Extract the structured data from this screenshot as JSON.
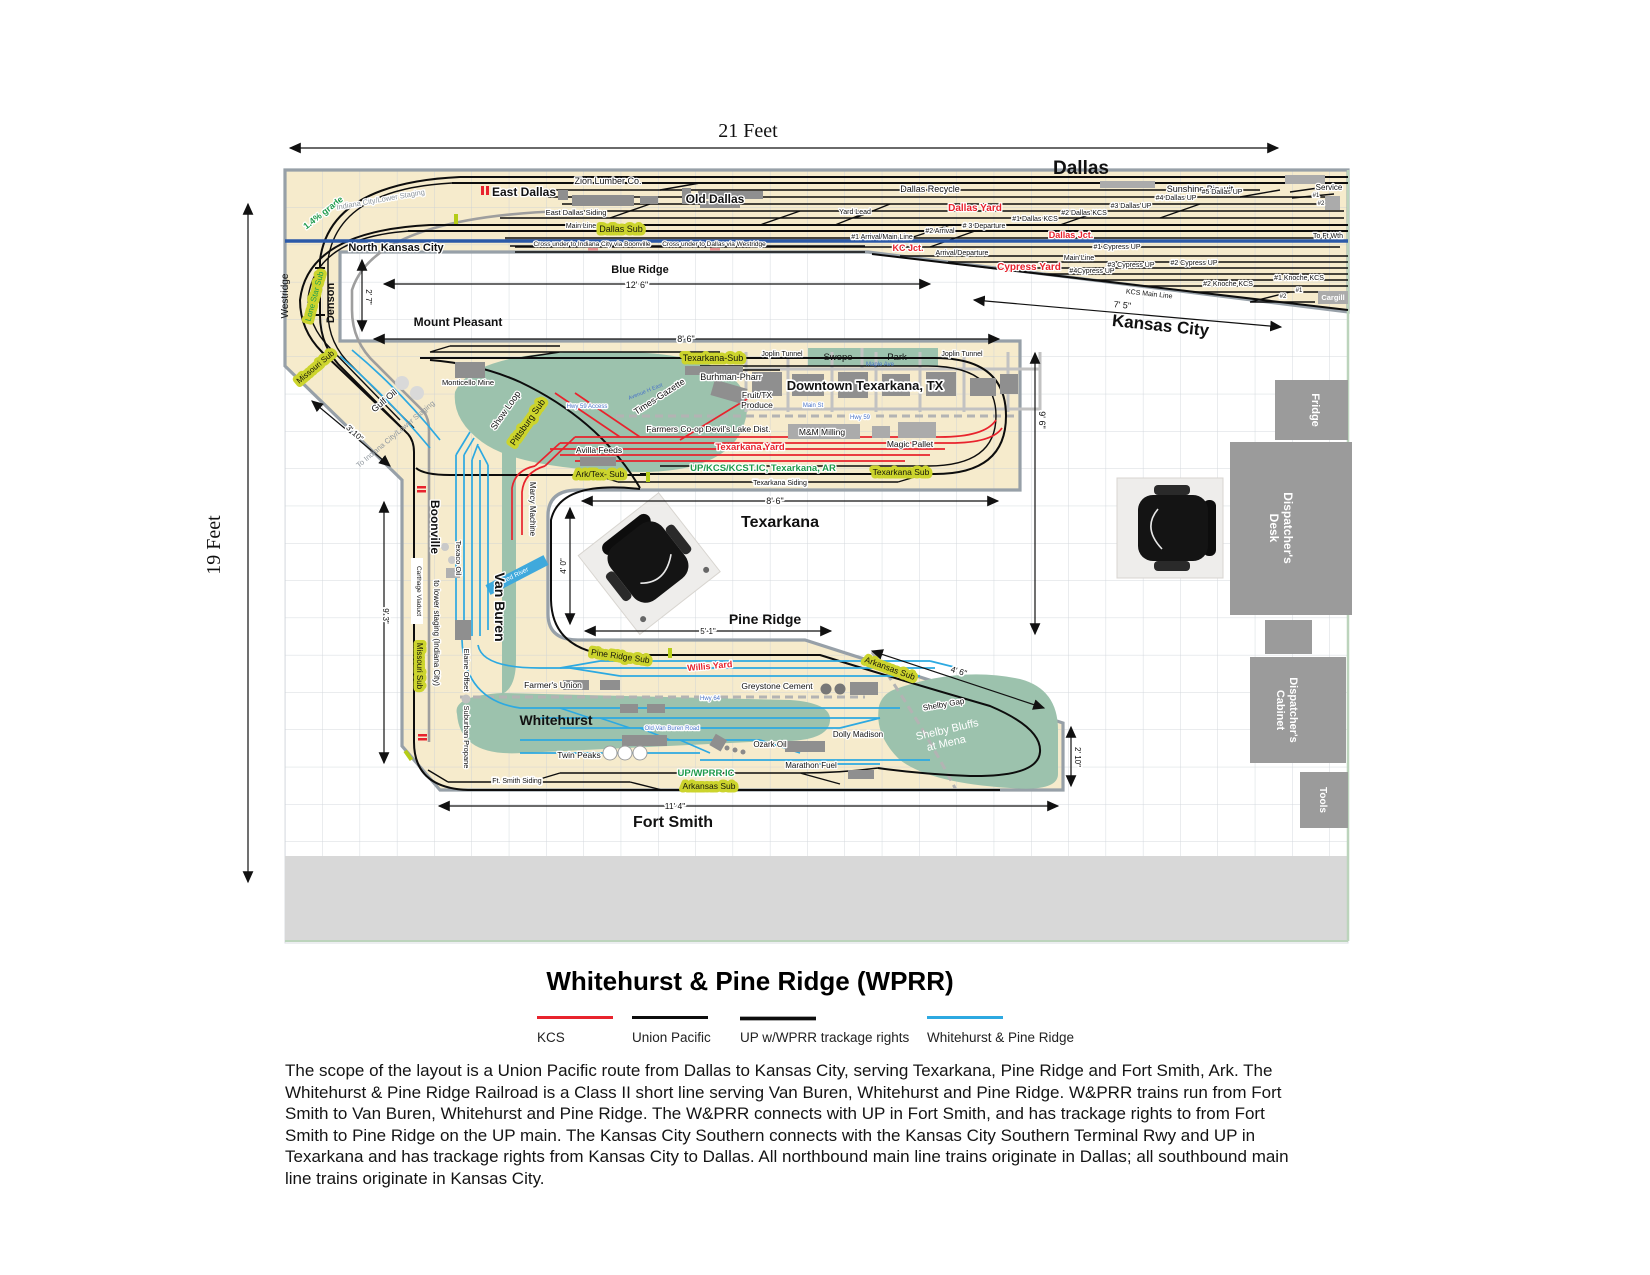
{
  "page": {
    "width_label": "21 Feet",
    "height_label": "19 Feet",
    "title": "Whitehurst & Pine Ridge (WPRR)",
    "description": "The scope of the layout is a Union Pacific route from Dallas to Kansas City, serving Texarkana, Pine Ridge and Fort Smith, Ark. The Whitehurst & Pine Ridge Railroad is a Class II short line serving Van Buren, Whitehurst and Pine Ridge. W&PRR trains run from Fort Smith to Van Buren, Whitehurst and Pine Ridge. The W&PRR connects with UP in Fort Smith, and has trackage rights to from Fort Smith to Pine Ridge on the UP main. The Kansas City Southern connects with the Kansas City Southern Terminal Rwy and UP in Texarkana and has trackage rights from Kansas City to Dallas. All northbound main line trains originate in Dallas; all southbound main line trains originate in Kansas City."
  },
  "legend": {
    "kcs": "KCS",
    "up": "Union Pacific",
    "up_wprr": "UP w/WPRR trackage rights",
    "wprr": "Whitehurst & Pine Ridge"
  },
  "colors": {
    "kcs": "#e8232d",
    "union_pacific": "#0d0d0d",
    "wprr": "#2da9e1",
    "benchwork": "#f6ebcc",
    "scenery": "#9cc2ad",
    "sub_highlight": "#ccd42d",
    "staging": "#9e9e9e",
    "room_main": "#2b59a8"
  },
  "towns": {
    "dallas": "Dallas",
    "east_dallas": "East Dallas",
    "old_dallas": "Old Dallas",
    "north_kansas_city": "North Kansas City",
    "kansas_city": "Kansas City",
    "blue_ridge": "Blue Ridge",
    "mount_pleasant": "Mount Pleasant",
    "denson": "Denson",
    "westridge": "Westridge",
    "texarkana": "Texarkana",
    "downtown_texarkana": "Downtown Texarkana, TX",
    "swope": "Swope",
    "park": "Park",
    "pine_ridge": "Pine Ridge",
    "boonville": "Boonville",
    "van_buren": "Van Buren",
    "whitehurst": "Whitehurst",
    "fort_smith": "Fort Smith"
  },
  "yards": {
    "dallas_yard": "Dallas Yard",
    "cypress_yard": "Cypress Yard",
    "texarkana_yard": "Texarkana Yard",
    "willis_yard": "Willis Yard",
    "yard_lead": "Yard Lead",
    "dallas_jct": "Dallas Jct.",
    "kc_jct": "KC Jct."
  },
  "tracks": {
    "d1": "#1 Dallas KCS",
    "d2": "#2 Dallas KCS",
    "d3": "#3 Dallas UP",
    "d4": "#4 Dallas UP",
    "d5": "#5 Dallas UP",
    "dep3": "# 3 Departure",
    "arr2": "#2 Arrival",
    "arr1": "#1 Arrival/Main Line",
    "arr_dep": "Arrival/Departure",
    "main_line": "Main Line",
    "cyp1": "#1 Cypress UP",
    "cyp2": "#2 Cypress UP",
    "cyp3": "#3 Cypress UP",
    "cyp4": "#4Cypress UP",
    "kno1": "#1 Knoche KCS",
    "kno2": "#2 Knoche KCS",
    "kcs_main": "KCS Main Line",
    "east_dallas_siding": "East Dallas Siding",
    "texarkana_siding": "Texarkana Siding",
    "ft_smith_siding": "Ft. Smith Siding",
    "to_ft_wth": "To Ft Wth",
    "service": "Service",
    "sv1": "#1",
    "sv2": "#2",
    "cargill": "Cargill",
    "cg1": "#1",
    "cg2": "#2",
    "cross_boonville": "Cross under to Indiana City via Boonville",
    "cross_westridge": "Cross under to Dallas via Westridge",
    "joplin_tunnel": "Joplin Tunnel",
    "up_kcs_ic": "UP/KCS/KCST.IC, Texarkana, AR",
    "up_wprr_ic": "UP/WPRR IC",
    "grade": "1.4% grade",
    "indiana_staging": "Indiana City/Lower Staging",
    "to_indiana_staging": "To Indiana City/Lower Staging",
    "to_lower_staging": "to lower staging (Indiana City)",
    "show_loop": "Show Loop",
    "shelby_gap": "Shelby Gap",
    "shelby1": "Shelby Bluffs",
    "shelby2": "at Mena"
  },
  "subs": {
    "dallas_sub": "Dallas Sub",
    "lone_star_sub": "Lone Star Sub",
    "sub_level": "Sub Level",
    "missouri_sub": "Missouri Sub",
    "pittsburg_sub": "Pittsburg Sub",
    "texarkana_sub_n": "Texarkana-Sub",
    "texarkana_sub_s": "Texarkana Sub",
    "ark_tex_sub": "Ark/Tex- Sub",
    "pine_ridge_sub": "Pine Ridge Sub",
    "arkansas_sub": "Arkansas Sub"
  },
  "industries": {
    "zion": "Zion Lumber Co.",
    "recycle": "Dallas Recycle",
    "sunshine": "Sunshine Biscuit",
    "monticello": "Monticello Mine",
    "gulf_oil": "Gulf Oil",
    "texaco": "Texaco Oil",
    "marcy": "Marcy Machine",
    "elaine": "Elaine Offset",
    "suburban": "Suburban Propane",
    "burhman": "Burhman-Pharr",
    "times_gazette": "Times-Gazette",
    "fruit1": "Fruit/TX",
    "fruit2": "Produce",
    "farmers_coop": "Farmers Co-op",
    "devils_lake": "Devil's Lake Dist.",
    "mm_milling": "M&M Milling",
    "magic_pallet": "Magic Pallet",
    "avilla": "Avilla Feeds",
    "farmers_union": "Farmer's Union",
    "greystone": "Greystone Cement",
    "dolly": "Dolly Madison",
    "ozark": "Ozark Oil",
    "twin_peaks": "Twin Peaks",
    "marathon": "Marathon Fuel"
  },
  "streets": {
    "maple": "Maple Ave",
    "main_st": "Main St",
    "hwy59": "Hwy 59",
    "hwy59_access": "Hwy 59 Access",
    "hwy64": "Hwy 64",
    "old_van_buren": "Old Van Buren Road",
    "avenue_h": "Avenue H East",
    "red_river": "Red River",
    "carthage": "Carthage Viaduct"
  },
  "dims": {
    "d12_6": "12' 6\"",
    "d2_7": "2' 7\"",
    "d8_6mp": "8' 6\"",
    "d7_5": "7' 5\"",
    "d3_10": "3' 10\"",
    "d8_6tx": "8' 6\"",
    "d9_6": "9' 6\"",
    "d4_0": "4' 0\"",
    "d5_1": "5' 1\"",
    "d9_3": "9' 3\"",
    "d4_6": "4' 6\"",
    "d2_10": "2' 10\"",
    "d11_4": "11' 4\""
  },
  "furniture": {
    "fridge": "Fridge",
    "desk1": "Dispatcher's",
    "desk2": "Desk",
    "cab1": "Dispatcher's",
    "cab2": "Cabinet",
    "tools": "Tools"
  }
}
